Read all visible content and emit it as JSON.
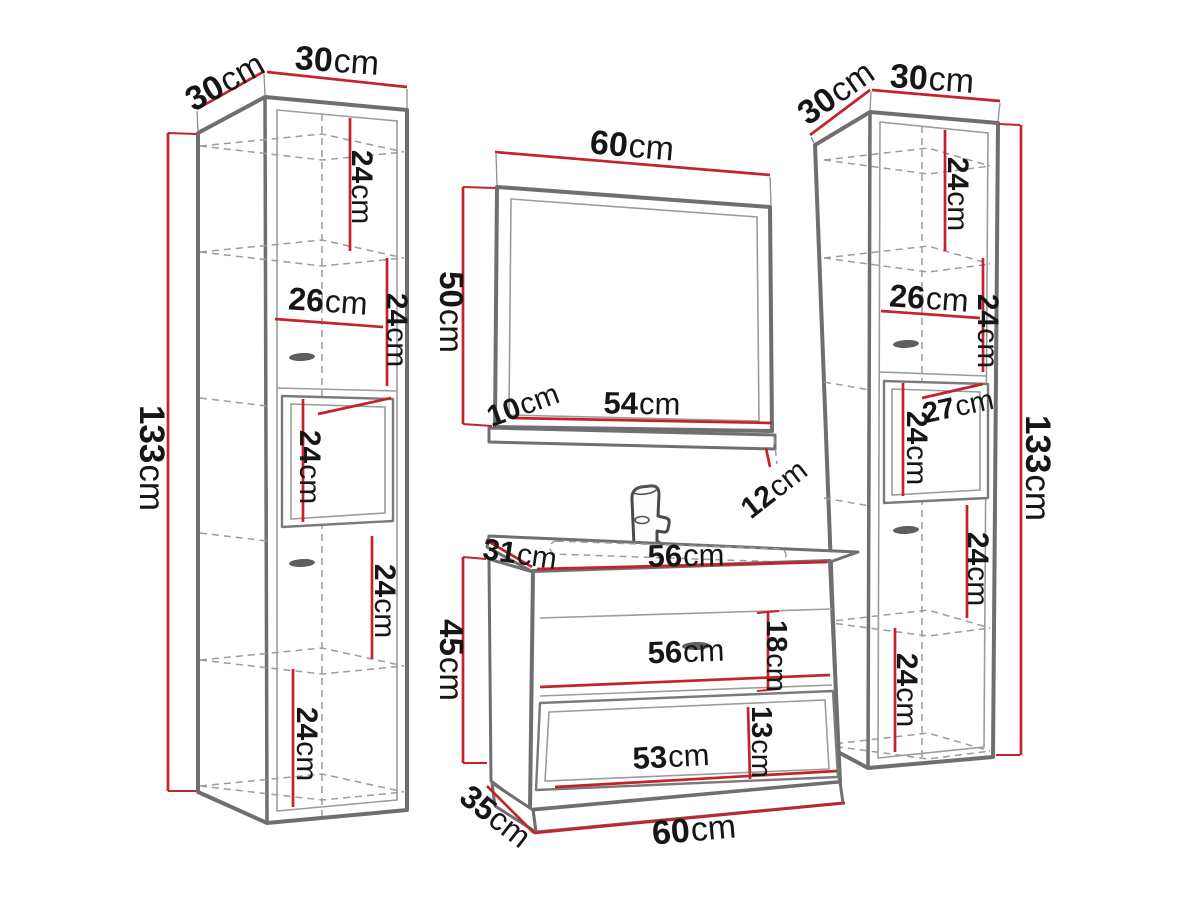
{
  "colors": {
    "dimension_line": "#c4232b",
    "furniture_outline": "#6f6f6f",
    "secondary_line": "#9c9c9c",
    "label_text": "#161616",
    "background": "#ffffff"
  },
  "dims": {
    "lc": {
      "depth": {
        "v": "30",
        "u": "cm"
      },
      "width": {
        "v": "30",
        "u": "cm"
      },
      "height": {
        "v": "133",
        "u": "cm"
      },
      "s1": {
        "v": "24",
        "u": "cm"
      },
      "inner_width": {
        "v": "26",
        "u": "cm"
      },
      "s2": {
        "v": "24",
        "u": "cm"
      },
      "s3": {
        "v": "24",
        "u": "cm"
      },
      "s4": {
        "v": "24",
        "u": "cm"
      },
      "s5": {
        "v": "24",
        "u": "cm"
      }
    },
    "mirror": {
      "width": {
        "v": "60",
        "u": "cm"
      },
      "height": {
        "v": "50",
        "u": "cm"
      },
      "shelf_offset": {
        "v": "10",
        "u": "cm"
      },
      "shelf_width": {
        "v": "54",
        "u": "cm"
      },
      "shelf_drop": {
        "v": "12",
        "u": "cm"
      }
    },
    "vanity": {
      "top_depth": {
        "v": "31",
        "u": "cm"
      },
      "top_width": {
        "v": "56",
        "u": "cm"
      },
      "height": {
        "v": "45",
        "u": "cm"
      },
      "drawer_height": {
        "v": "18",
        "u": "cm"
      },
      "drawer_width": {
        "v": "56",
        "u": "cm"
      },
      "niche_height": {
        "v": "13",
        "u": "cm"
      },
      "niche_width": {
        "v": "53",
        "u": "cm"
      },
      "base_depth": {
        "v": "35",
        "u": "cm"
      },
      "base_width": {
        "v": "60",
        "u": "cm"
      }
    },
    "rc": {
      "depth": {
        "v": "30",
        "u": "cm"
      },
      "width": {
        "v": "30",
        "u": "cm"
      },
      "height": {
        "v": "133",
        "u": "cm"
      },
      "s1": {
        "v": "24",
        "u": "cm"
      },
      "inner_width": {
        "v": "26",
        "u": "cm"
      },
      "s2": {
        "v": "24",
        "u": "cm"
      },
      "door_width": {
        "v": "27",
        "u": "cm"
      },
      "s3": {
        "v": "24",
        "u": "cm"
      },
      "s4": {
        "v": "24",
        "u": "cm"
      },
      "s5": {
        "v": "24",
        "u": "cm"
      }
    }
  }
}
